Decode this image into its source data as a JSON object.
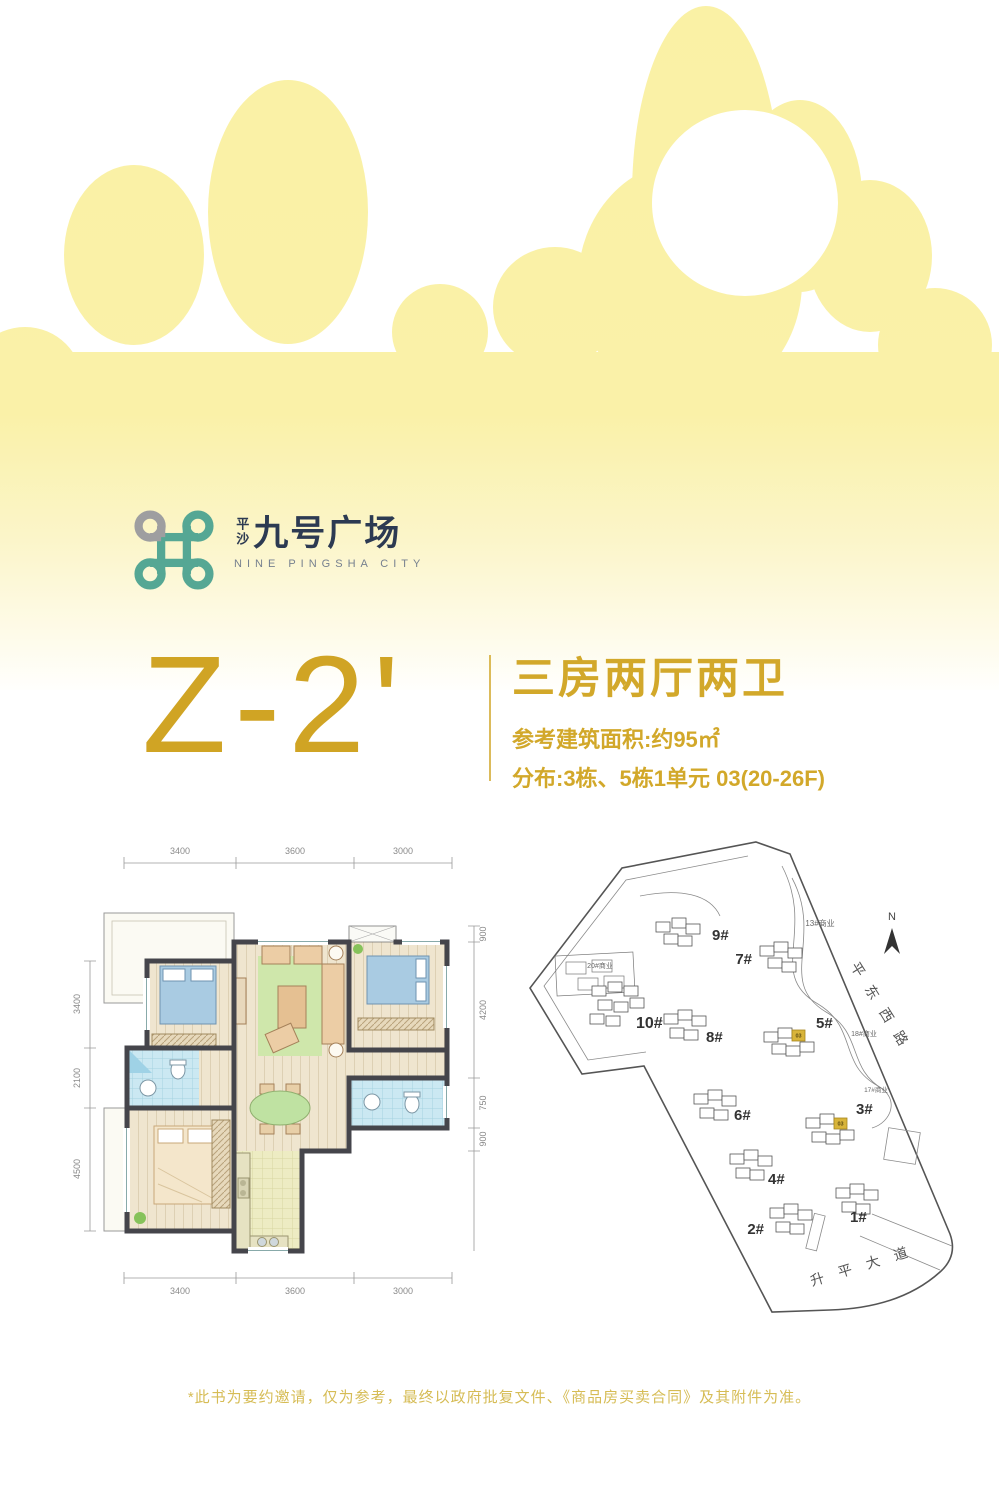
{
  "colors": {
    "cloud_yellow": "#faf1a5",
    "gold": "#d0a424",
    "gold_light": "#d6bc55",
    "brand_dark": "#2c3a52",
    "logo_teal": "#55a794",
    "logo_gray": "#9e9ea0",
    "highlight_gold": "#d8b43a"
  },
  "logo": {
    "cn_small": "平沙",
    "cn_main": "九号广场",
    "en": "NINE PINGSHA CITY"
  },
  "headline": {
    "unit_code": "Z-2'",
    "layout": "三房两厅两卫",
    "area_line": "参考建筑面积:约95㎡",
    "distribution_line": "分布:3栋、5栋1单元 03(20-26F)"
  },
  "floorplan": {
    "dims_top": [
      "3400",
      "3600",
      "3000"
    ],
    "dims_bottom": [
      "3400",
      "3600",
      "3000"
    ],
    "dims_left": [
      "3400",
      "2100",
      "4500"
    ],
    "dims_right": [
      "900",
      "4200",
      "750",
      "900"
    ]
  },
  "siteplan": {
    "north_label": "N",
    "roads": [
      "平东西路",
      "升平大道"
    ],
    "commercial": [
      "13#商业",
      "18#商业",
      "20#商业",
      "17#商业"
    ],
    "buildings": [
      "1#",
      "2#",
      "3#",
      "4#",
      "5#",
      "6#",
      "7#",
      "8#",
      "9#",
      "10#"
    ],
    "highlight_unit": "03"
  },
  "disclaimer": "*此书为要约邀请，仅为参考，最终以政府批复文件、《商品房买卖合同》及其附件为准。"
}
